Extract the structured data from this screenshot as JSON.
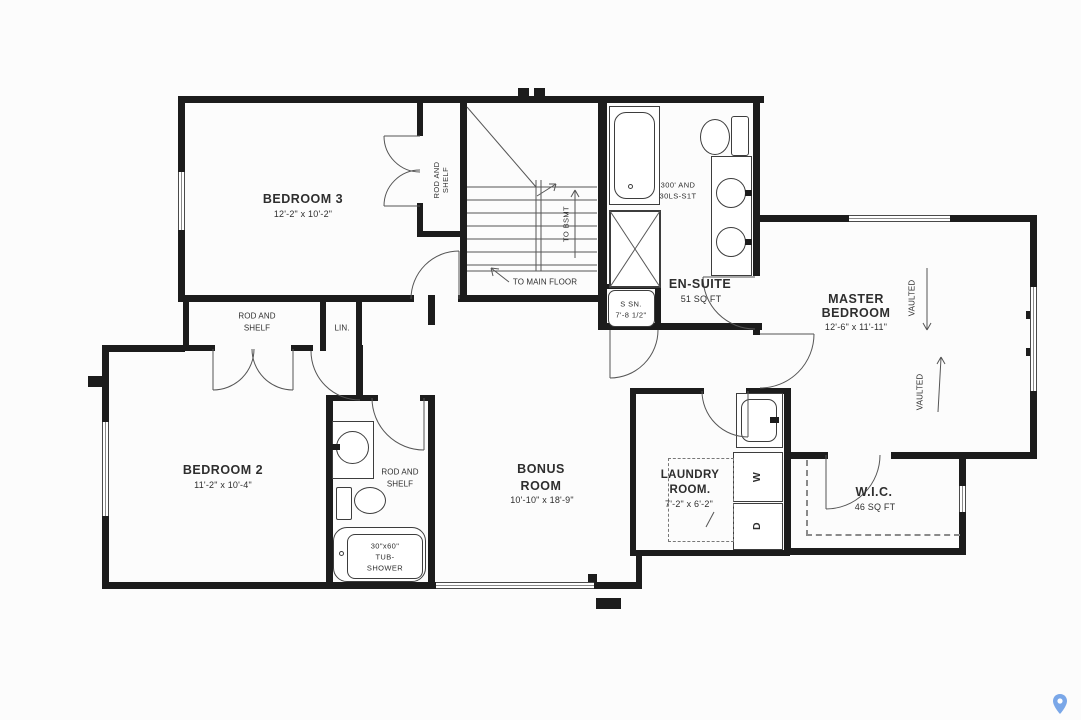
{
  "page": {
    "background": "#fcfcfc",
    "wall_color": "#1c1c1c",
    "line_color": "#555555",
    "text_color": "#2e2e2e",
    "watermark_color": "#7aa7e8"
  },
  "rooms": {
    "bedroom3": {
      "name": "BEDROOM 3",
      "dims": "12'-2\" x 10'-2\""
    },
    "bedroom2": {
      "name": "BEDROOM 2",
      "dims": "11'-2\" x 10'-4\""
    },
    "master_bedroom": {
      "name_line1": "MASTER",
      "name_line2": "BEDROOM",
      "dims": "12'-6\" x 11'-11\"",
      "vaulted_label": "VAULTED"
    },
    "bonus_room": {
      "name_line1": "BONUS",
      "name_line2": "ROOM",
      "dims": "10'-10\" x 18'-9\""
    },
    "ensuite": {
      "name": "EN-SUITE",
      "area": "51 SQ FT",
      "fixture_note_line1": "300' AND",
      "fixture_note_line2": "30LS-S1T"
    },
    "laundry_room": {
      "name_line1": "LAUNDRY",
      "name_line2": "ROOM.",
      "dims": "7'-2\" x 6'-2\"",
      "washer_label": "W",
      "dryer_label": "D"
    },
    "wic": {
      "name": "W.I.C.",
      "area": "46 SQ FT"
    },
    "bathroom": {
      "note_line1": "ROD AND",
      "note_line2": "SHELF",
      "tub_size": "30\"x60\"",
      "tub_line2": "TUB-",
      "tub_line3": "SHOWER"
    }
  },
  "closets": {
    "bedroom3_closet_line1": "ROD AND",
    "bedroom3_closet_line2": "SHELF",
    "bedroom2_closet_line1": "ROD AND",
    "bedroom2_closet_line2": "SHELF",
    "linen": "LIN.",
    "small_closet_line1": "S SN.",
    "small_closet_line2": "7'-8 1/2\""
  },
  "stairs": {
    "to_basement_label": "TO BSMT",
    "to_main_floor_label": "TO MAIN FLOOR"
  }
}
